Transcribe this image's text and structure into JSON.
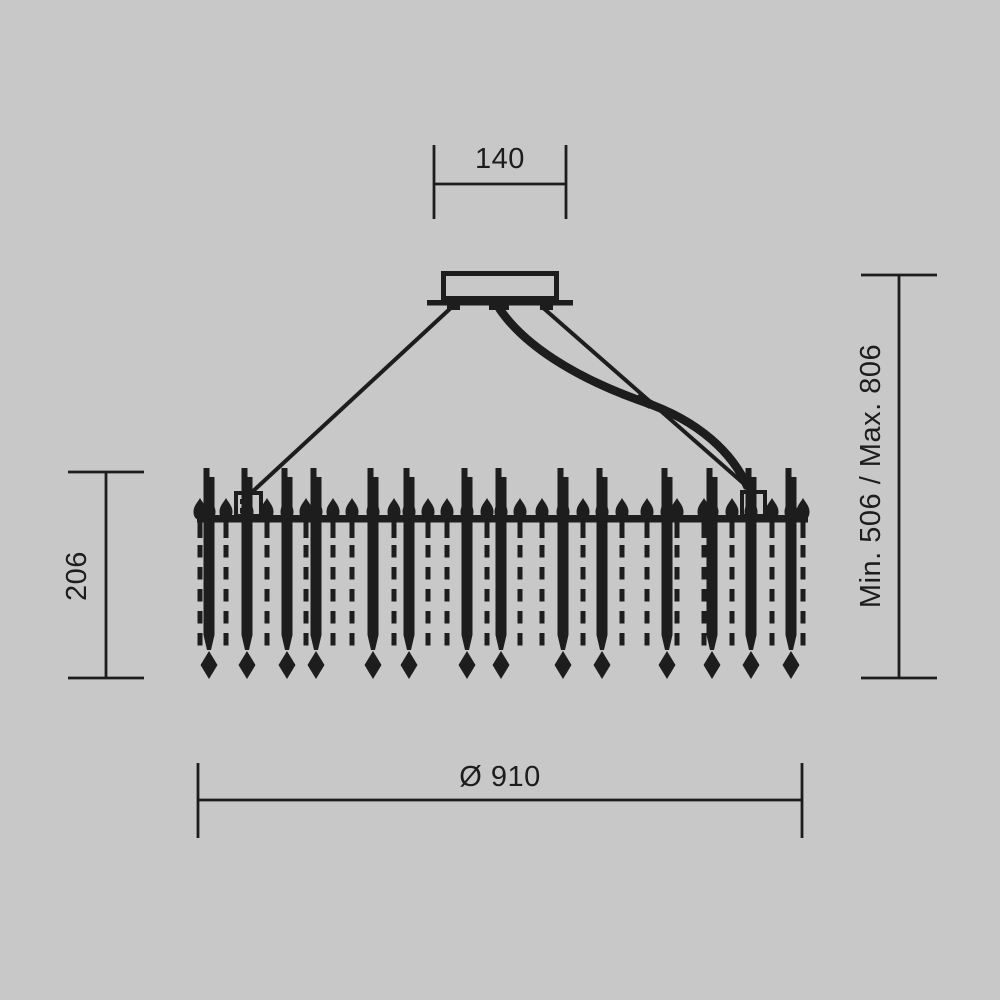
{
  "colors": {
    "background": "#c8c8c8",
    "ink": "#1d1d1d"
  },
  "dimension_labels": {
    "canopy_width": "140",
    "body_height": "206",
    "suspension_height": "Min. 506 / Max. 806",
    "diameter": "Ø 910"
  }
}
